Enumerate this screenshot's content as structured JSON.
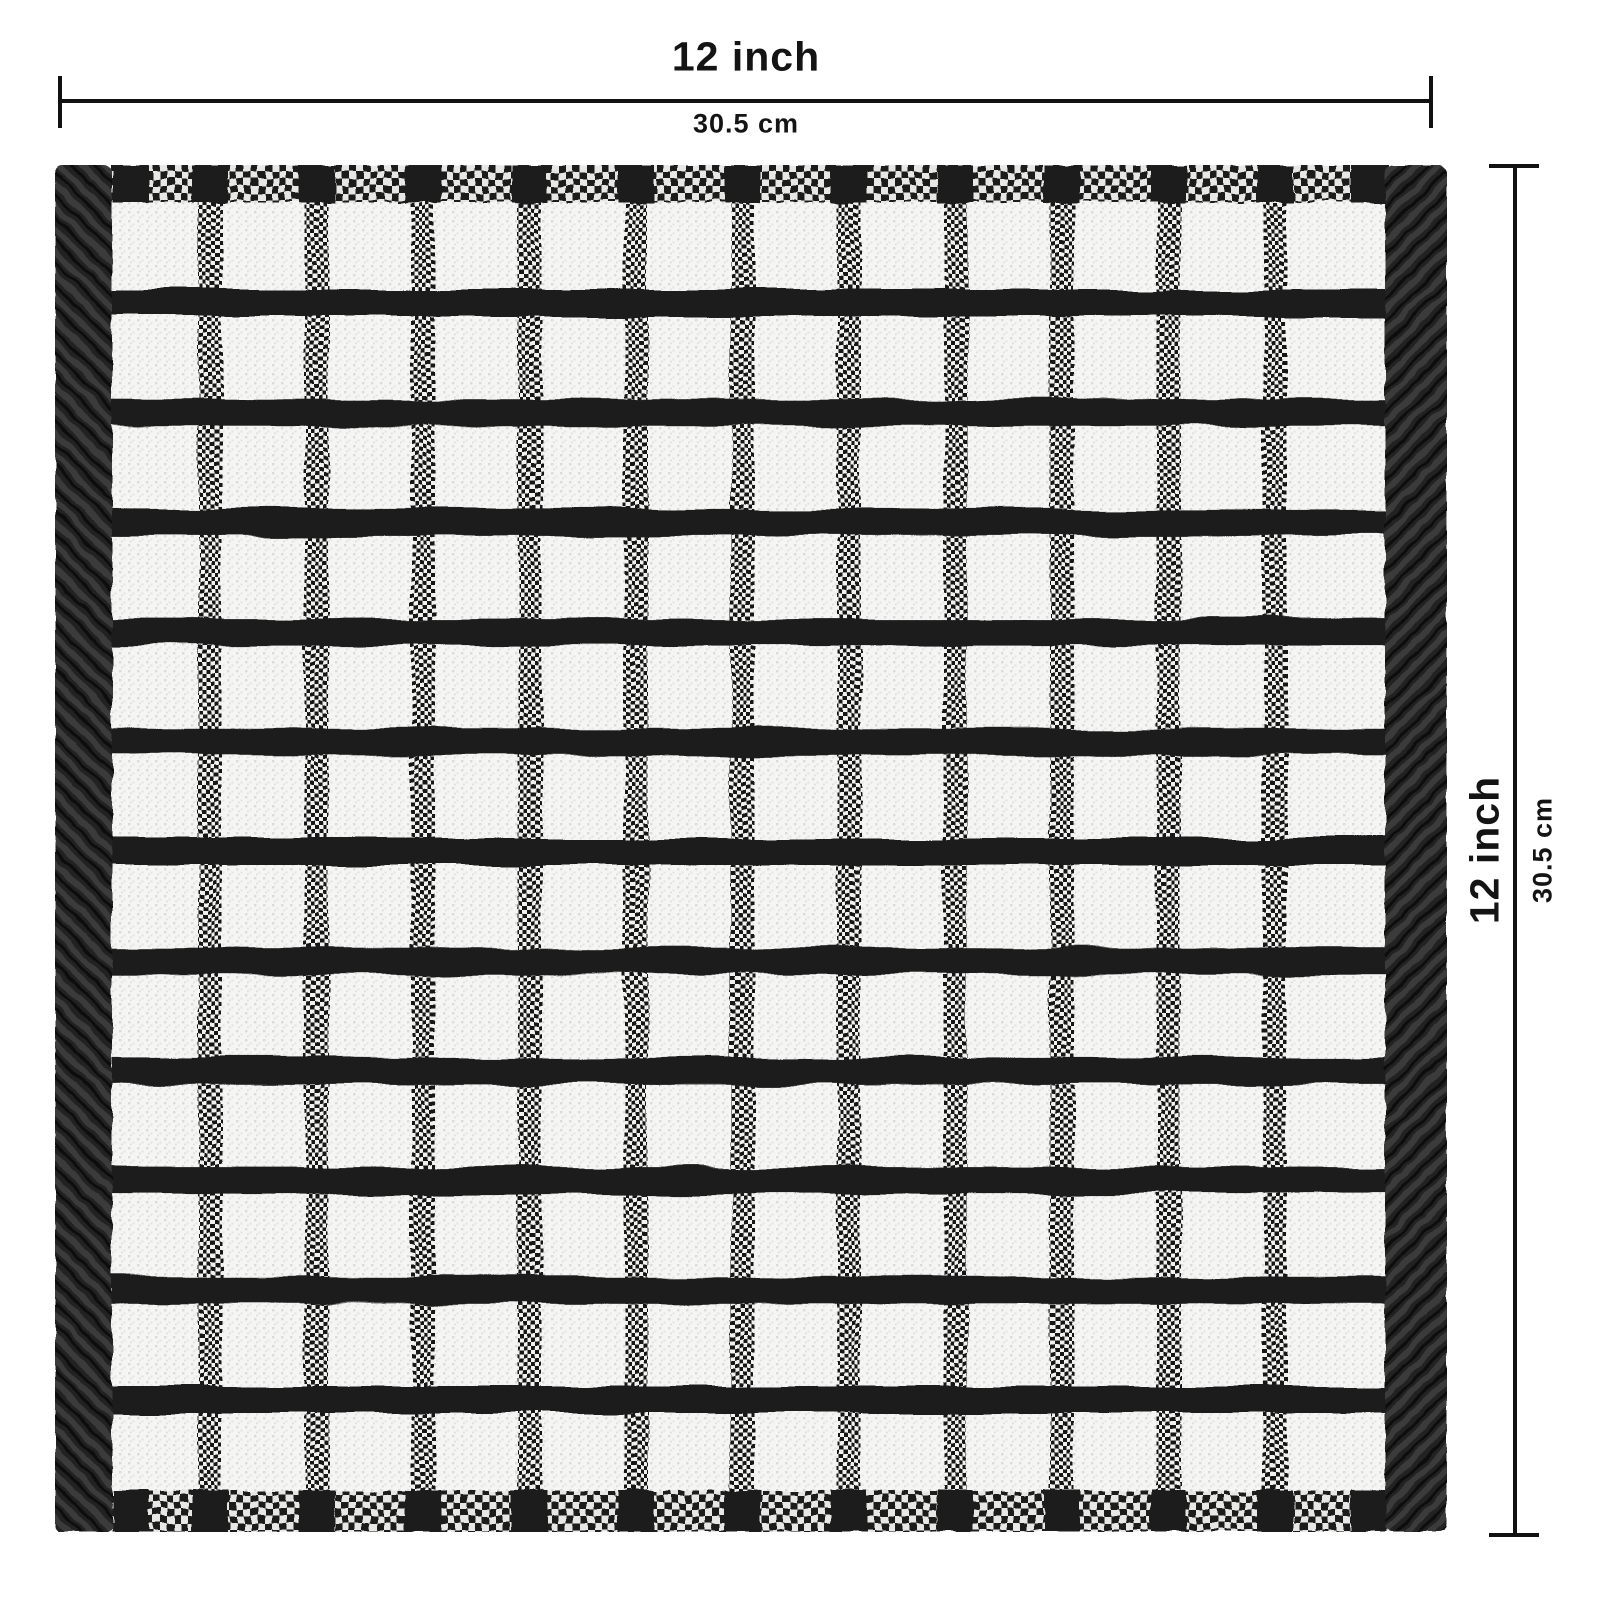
{
  "page": {
    "background": "#ffffff"
  },
  "dimensions": {
    "width": {
      "inch_label": "12 inch",
      "cm_label": "30.5 cm"
    },
    "height": {
      "inch_label": "12 inch",
      "cm_label": "30.5 cm"
    }
  },
  "towel": {
    "description": "black and white windowpane check terry dish cloth",
    "grid": {
      "white_columns": 12,
      "white_rows": 12,
      "vertical_stripes": 11,
      "horizontal_stripes": 11
    },
    "colors": {
      "ink": "#141414",
      "line": "#111111",
      "stripe_dark": "#1e1e1e",
      "border_dark": "#212121",
      "border_weave_light": "#3a3a3a",
      "band_light": "#e7e7e6",
      "band_dark": "#1b1b1b",
      "terry_white": "#f5f5f4",
      "speckle": "#c6c6c6",
      "dot_dark": "#161616",
      "dot_light": "#f1f1f0"
    }
  }
}
